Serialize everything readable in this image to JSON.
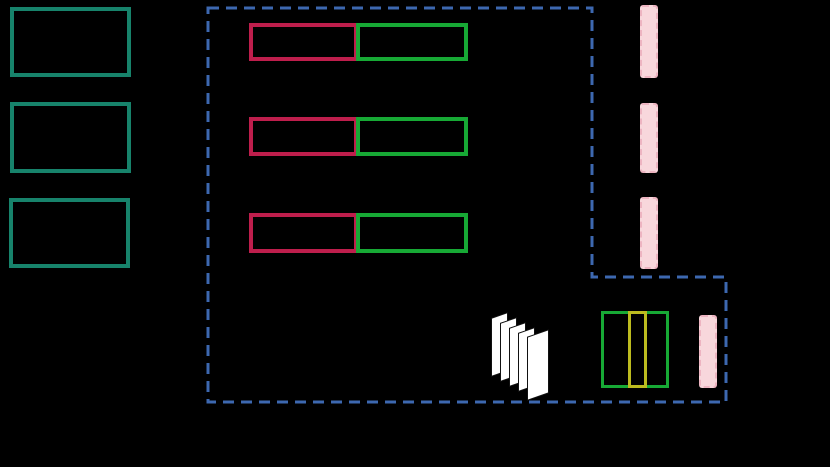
{
  "canvas": {
    "width_px": 830,
    "height_px": 467,
    "background": "#000000"
  },
  "colors": {
    "teal_border": "#17836B",
    "red_border": "#BE1E4C",
    "green_border": "#17A935",
    "blue_dash": "#3D68B0",
    "pink_fill": "#F8D7DC",
    "pink_edge": "#EDB4C1",
    "yellow_border": "#BCBB1F",
    "page_fill": "#FFFFFF"
  },
  "elements": {
    "left_stack": {
      "count": 3,
      "style": "teal-outline-box"
    },
    "dashed_container": {
      "shape": "L-shaped outline",
      "style": "blue-dashed",
      "path": "M208 8 H592 V277 H726 V402 H208 Z",
      "dash": "11 7",
      "stroke_width": 3
    },
    "pair_rows": {
      "count": 3,
      "left_style": "red-outline-box",
      "right_style": "green-outline-box"
    },
    "pink_bars": {
      "count": 4,
      "style": "pink-fill-scalloped-edge"
    },
    "pages_icon": {
      "page_count": 5,
      "style": "white-fanned-pages"
    },
    "partition_box": {
      "segments": [
        "green",
        "yellow",
        "green"
      ]
    }
  },
  "visible_text": []
}
